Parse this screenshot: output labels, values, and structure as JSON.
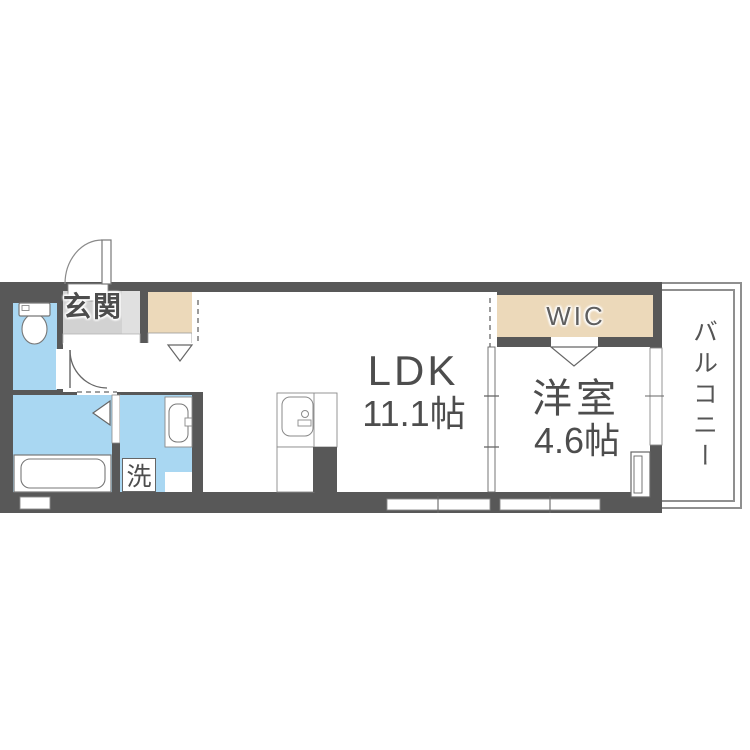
{
  "rooms": {
    "entrance": {
      "label": "玄関"
    },
    "ldk": {
      "name": "LDK",
      "area": "11.1帖"
    },
    "western_room": {
      "name": "洋室",
      "area": "4.6帖"
    },
    "wic": {
      "label": "WIC"
    },
    "balcony": {
      "label": "バルコニー"
    },
    "laundry": {
      "label": "洗"
    }
  },
  "colors": {
    "wall": "#585858",
    "water_area": "#a9d7f2",
    "storage": "#ecd9ba",
    "entrance_floor": "#d2d2d2",
    "entrance_floor_light": "#e0e0e0",
    "outline": "#777777",
    "text": "#4d4d4d",
    "canvas": "#ffffff"
  }
}
